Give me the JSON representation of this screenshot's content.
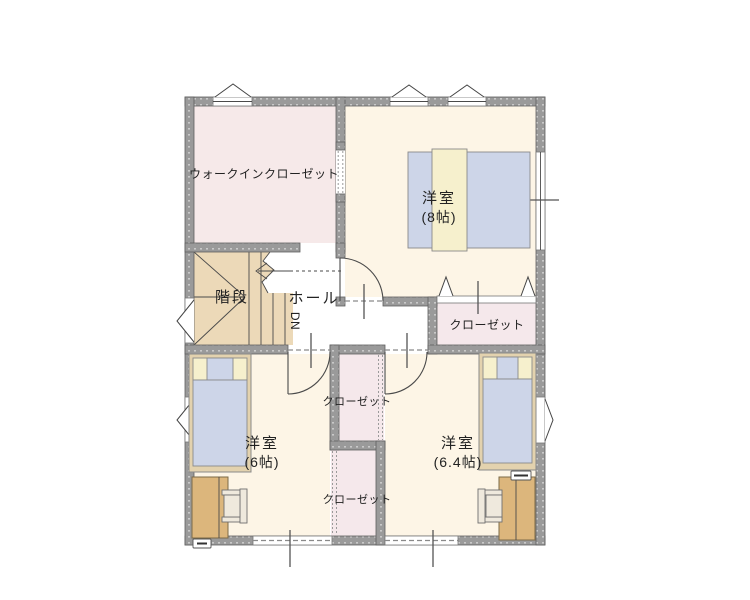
{
  "palette": {
    "wall": "#9a9a9a",
    "wall-edge": "#5f5f5f",
    "room-cream": "#fdf5e6",
    "room-pink": "#f6e9e9",
    "closet-pink": "#f5e8eb",
    "stairs-tan": "#ecd9b8",
    "bed-blue": "#cdd5e8",
    "pillow-cream": "#f6f0cd",
    "furniture-tan": "#dcb67c",
    "line": "#4a4a4a"
  },
  "rooms": {
    "walk_in_closet": {
      "label": "ウォークインクローゼット"
    },
    "bedroom8": {
      "label": "洋室",
      "size": "(8帖)"
    },
    "stairs": {
      "label": "階段"
    },
    "hall": {
      "label": "ホール",
      "down_marker": "DN"
    },
    "closet_main": {
      "label": "クローゼット"
    },
    "closet_upper": {
      "label": "クローゼット"
    },
    "closet_lower": {
      "label": "クローゼット"
    },
    "bedroom6": {
      "label": "洋室",
      "size": "(6帖)"
    },
    "bedroom64": {
      "label": "洋室",
      "size": "(6.4帖)"
    }
  }
}
